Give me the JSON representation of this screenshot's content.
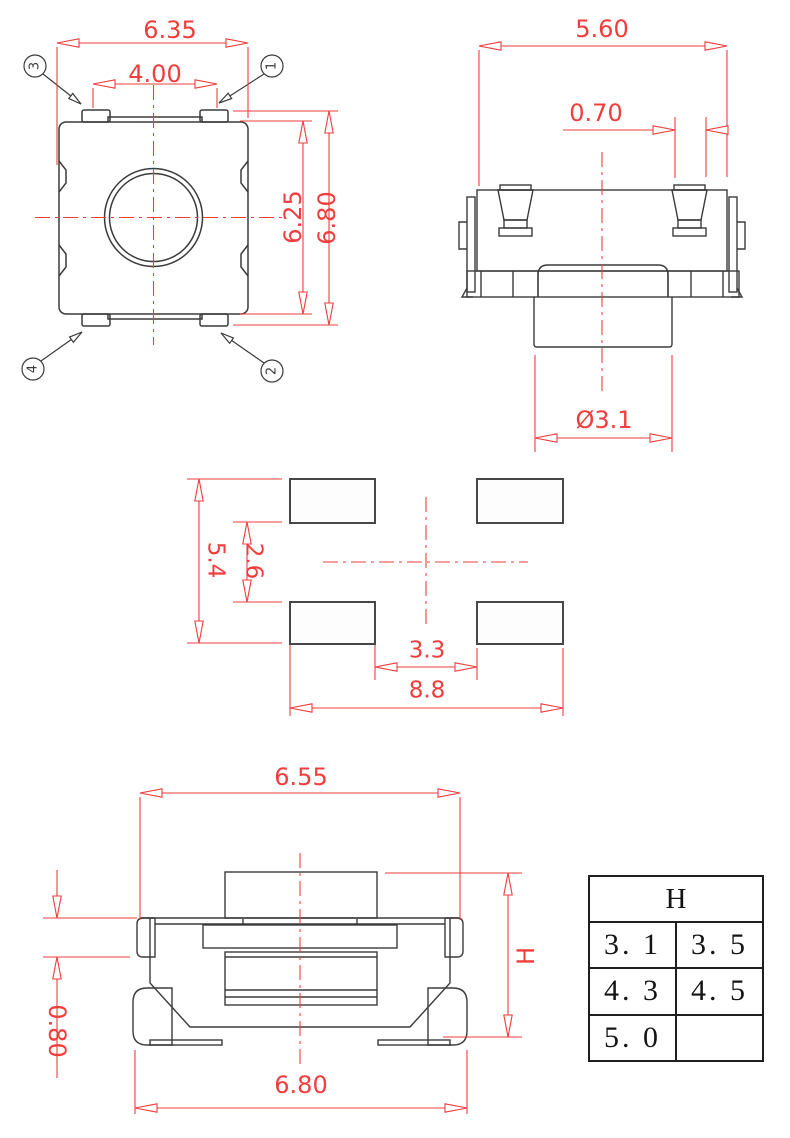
{
  "colors": {
    "dimension_red": "#f33c3c",
    "outline_gray": "#3b3b3b",
    "table_black": "#1e1e1e"
  },
  "top_view": {
    "dim_width_outer": "6.35",
    "dim_width_pins": "4.00",
    "dim_height_body": "6.25",
    "dim_height_overall": "6.80",
    "pin_labels": {
      "p1": "1",
      "p2": "2",
      "p3": "3",
      "p4": "4"
    }
  },
  "side_view": {
    "dim_width": "5.60",
    "dim_pin_offset": "0.70",
    "dim_actuator_diameter": "Ø3.1"
  },
  "land_pattern": {
    "dim_pad_outer_v": "5.4",
    "dim_pad_inner_v": "2.6",
    "dim_pad_inner_h": "3.3",
    "dim_pad_outer_h": "8.8"
  },
  "front_view": {
    "dim_width_top": "6.55",
    "dim_step": "0.80",
    "dim_height": "H",
    "dim_width_bottom": "6.80"
  },
  "height_table": {
    "header": "H",
    "rows": [
      [
        "3. 1",
        "3. 5"
      ],
      [
        "4. 3",
        "4. 5"
      ],
      [
        "5. 0",
        ""
      ]
    ]
  }
}
